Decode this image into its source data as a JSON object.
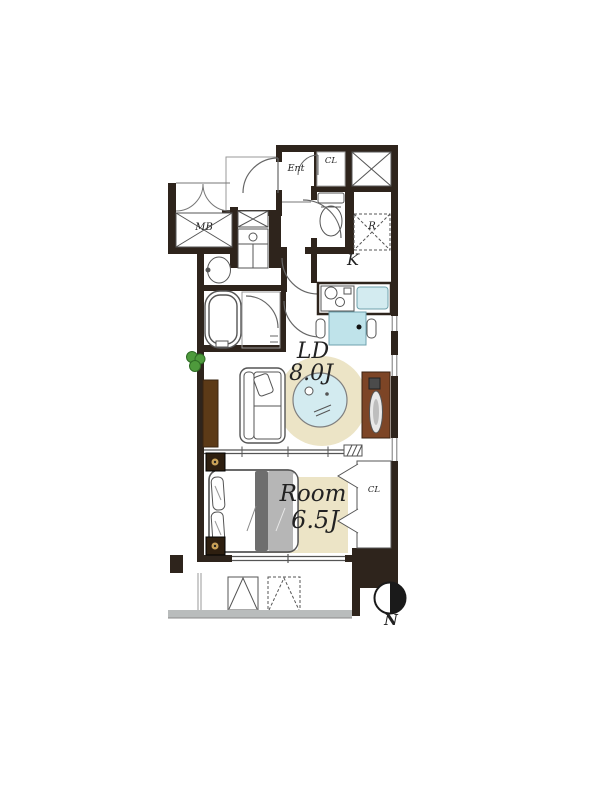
{
  "plan": {
    "title": "apartment-floor-plan",
    "labels": {
      "entrance": "Ent",
      "entrance_closet": "CL",
      "refrigerator_space": "R",
      "kitchen": "K",
      "meter_box": "MB",
      "living_dining_name": "LD",
      "living_dining_size": "8.0J",
      "bedroom_name": "Room",
      "bedroom_size": "6.5J",
      "bedroom_closet": "CL",
      "compass_north": "N"
    },
    "colors": {
      "wall": "#2e241c",
      "fixture_line": "#555555",
      "water_blue": "#d3ebf0",
      "rug_cream": "#ece4c6",
      "furniture_brown": "#7d4526",
      "console_brown": "#5c3a17",
      "blanket_gray": "#b6b6b6",
      "blanket_dark": "#6e6e6e",
      "plant_green": "#4e9a3c",
      "railing_gray": "#b9bcbc"
    }
  }
}
